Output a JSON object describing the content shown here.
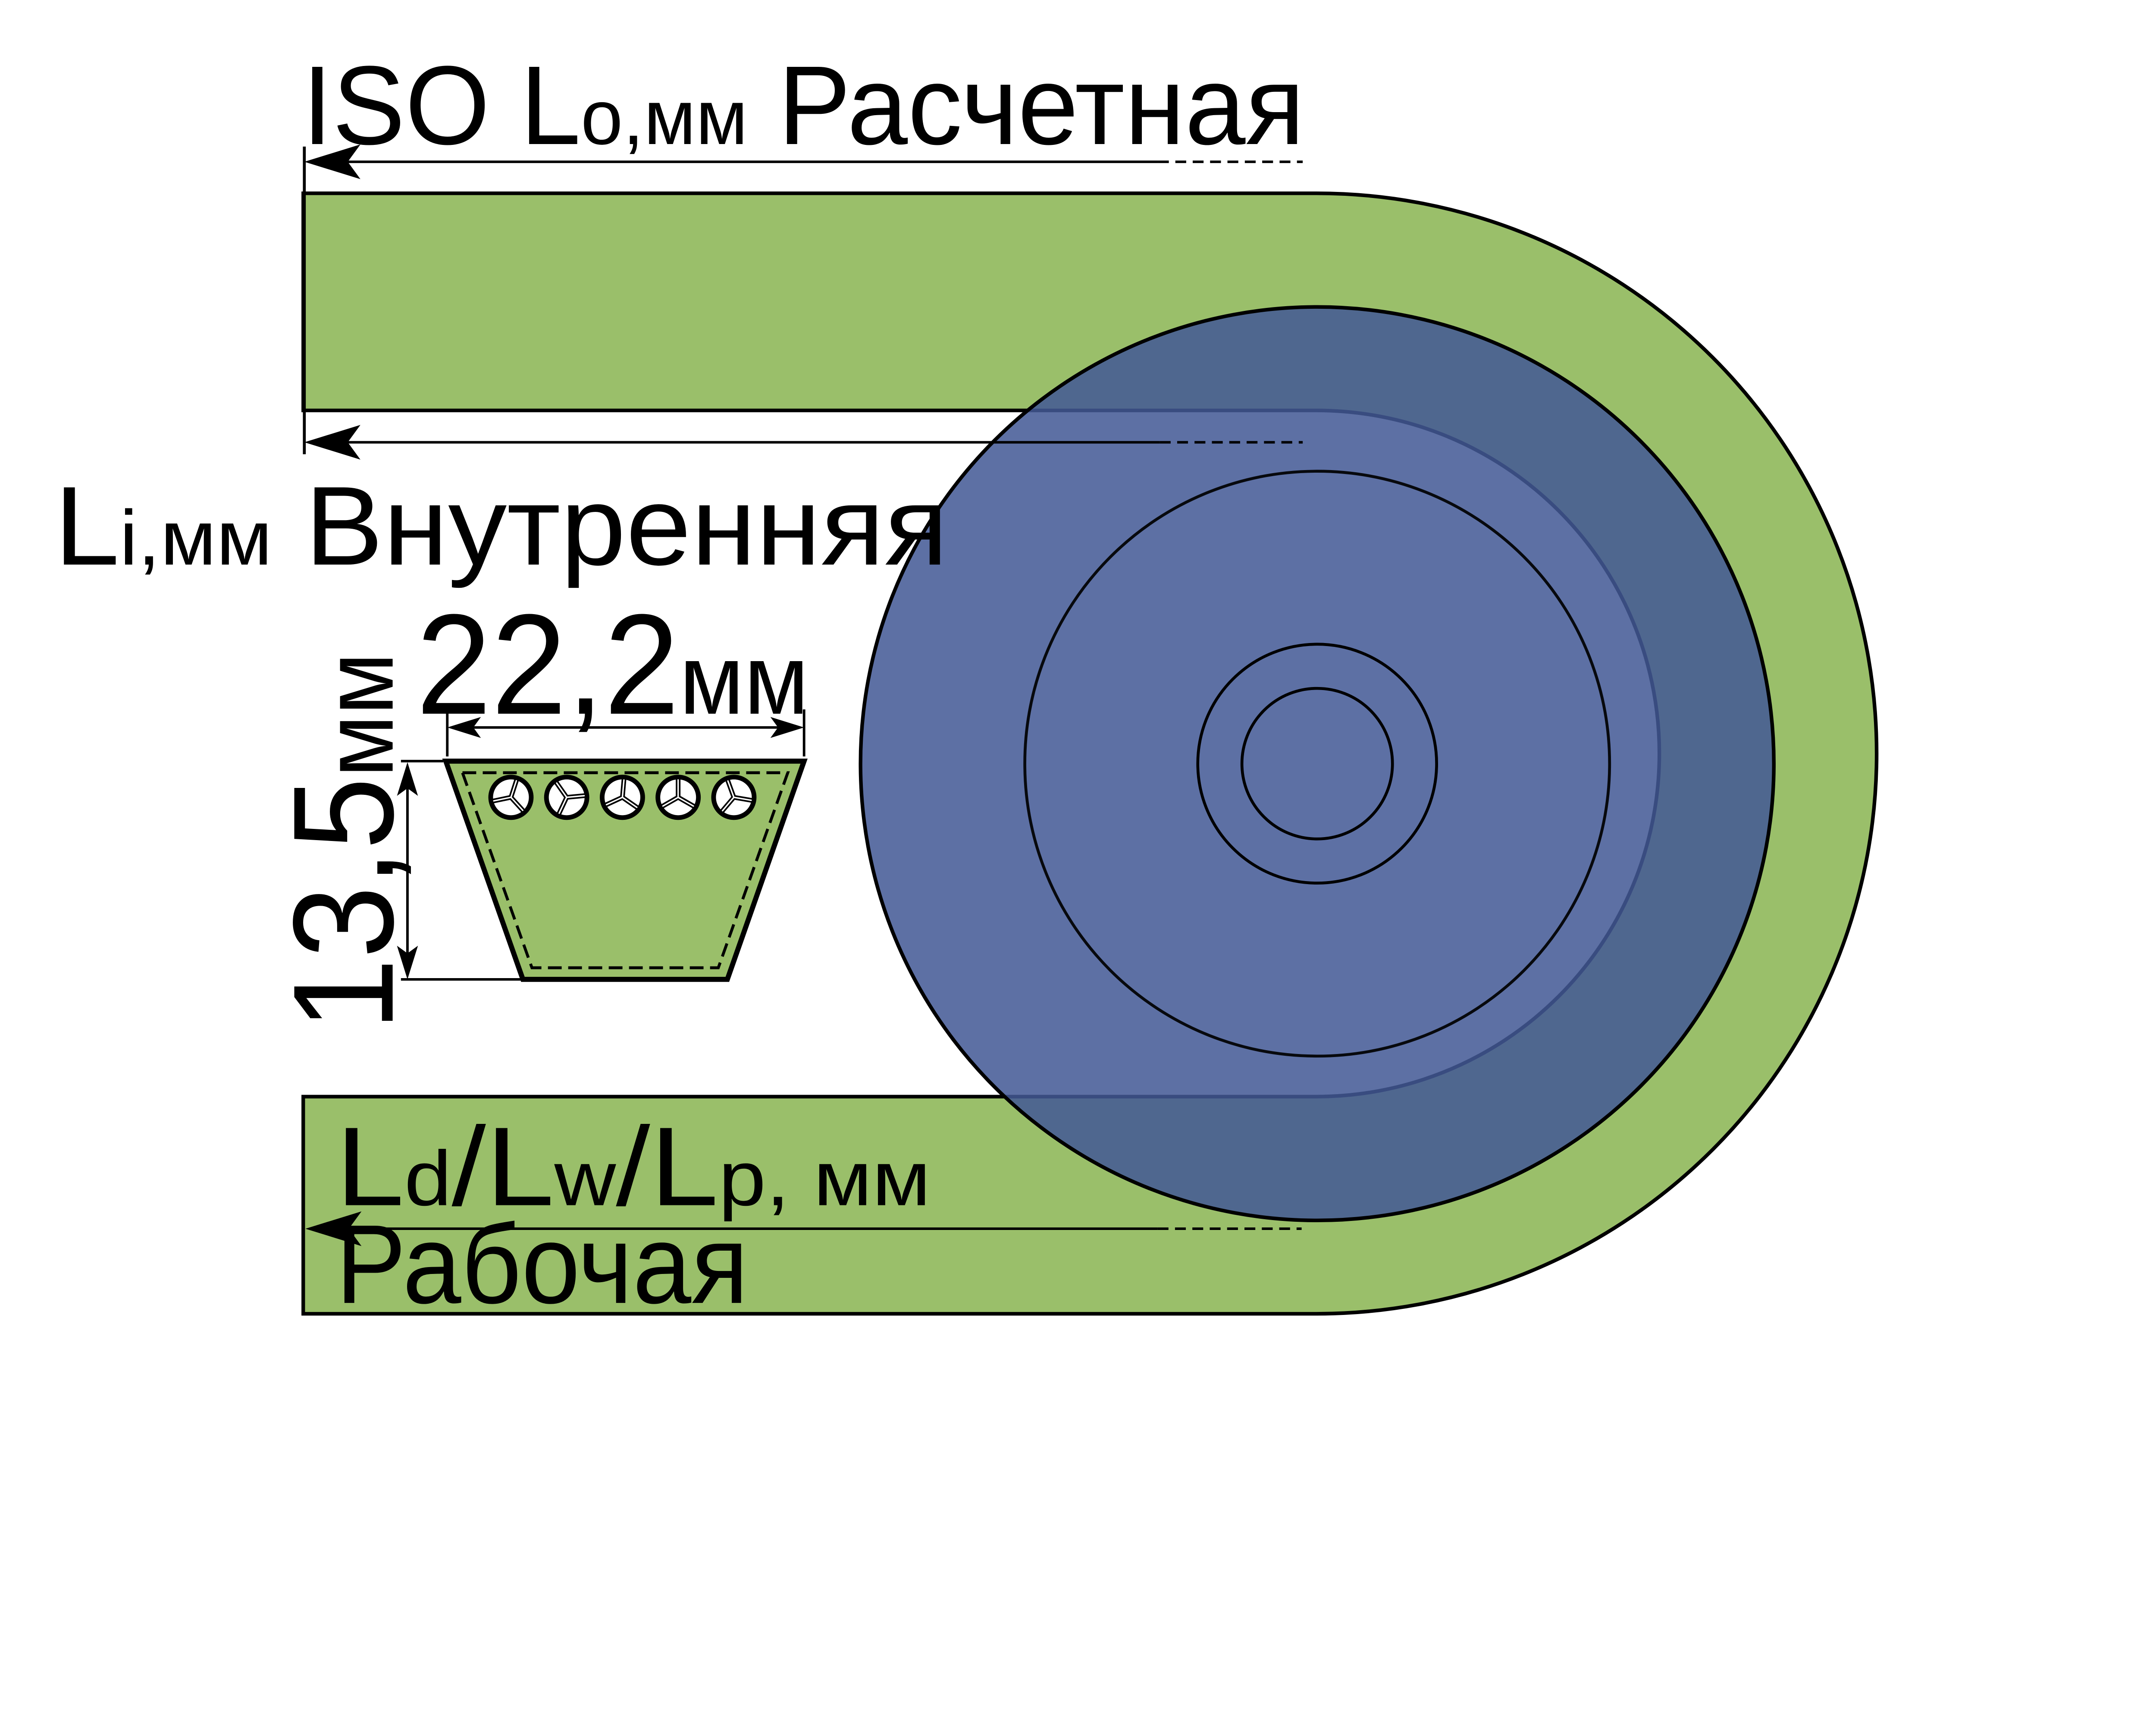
{
  "colors": {
    "background": "#ffffff",
    "belt_green": "#9abf6a",
    "pulley_blue": "#425995",
    "outline": "#000000",
    "cord_white": "#ffffff"
  },
  "labels": {
    "iso": {
      "main": "ISO L",
      "sub": "o",
      "units": ",мм",
      "tail": " Расчетная"
    },
    "li": {
      "main": "L",
      "sub": "i",
      "units": ",мм",
      "tail": " Внутренняя"
    },
    "ld": {
      "p1": "L",
      "s1": "d",
      "p2": "/L",
      "s2": "w",
      "p3": "/L",
      "s3": "p",
      "tail": ", мм"
    },
    "bottom_line": "Рабочая",
    "width_dim": {
      "value": "22,2",
      "unit": "мм"
    },
    "height_dim": {
      "value": "13,5",
      "unit": "мм"
    }
  }
}
